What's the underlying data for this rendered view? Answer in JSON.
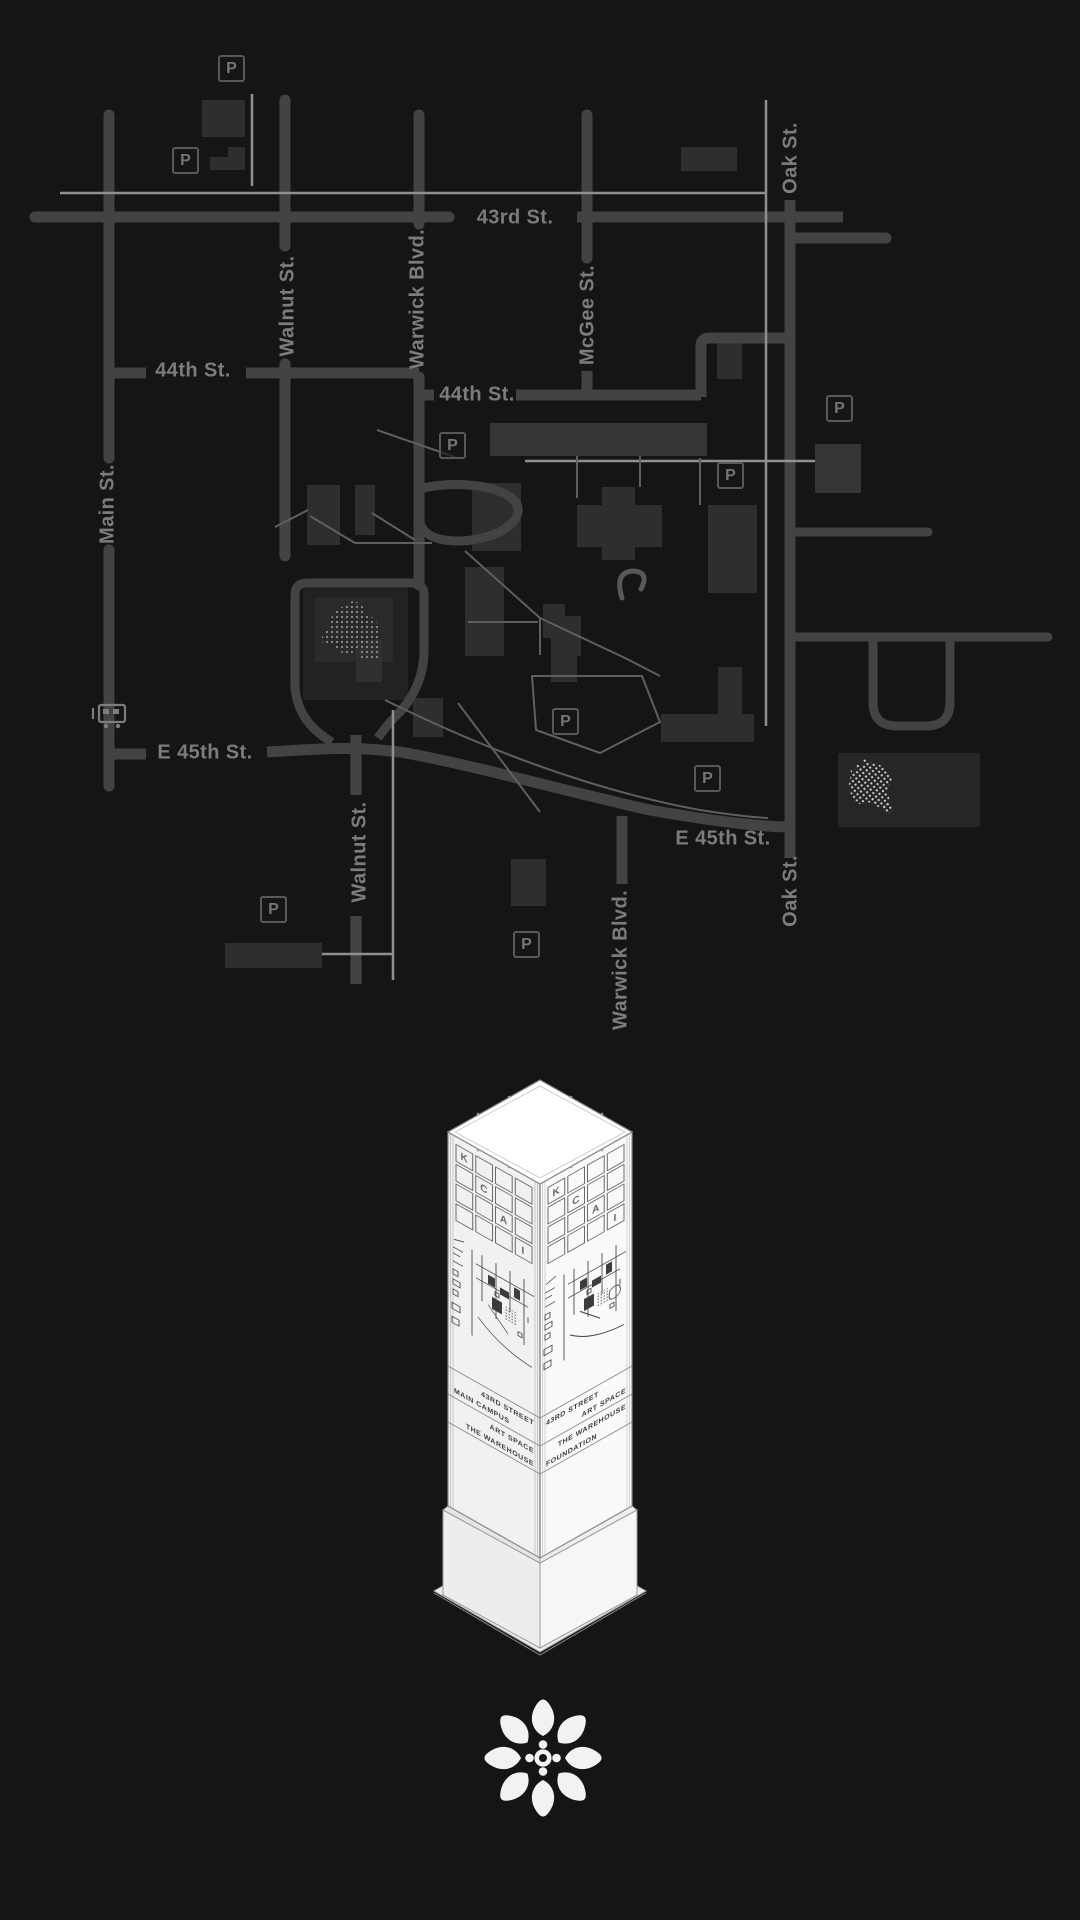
{
  "map": {
    "parking_letter": "P",
    "street_labels": [
      {
        "id": "43rd-st",
        "text": "43rd St."
      },
      {
        "id": "44th-st-left",
        "text": "44th St."
      },
      {
        "id": "44th-st-right",
        "text": "44th St."
      },
      {
        "id": "e-45th-st-west",
        "text": "E 45th St."
      },
      {
        "id": "e-45th-st-east",
        "text": "E 45th St."
      },
      {
        "id": "main-st",
        "text": "Main St."
      },
      {
        "id": "walnut-st-north",
        "text": "Walnut St."
      },
      {
        "id": "walnut-st-south",
        "text": "Walnut St."
      },
      {
        "id": "warwick-blvd-north",
        "text": "Warwick Blvd."
      },
      {
        "id": "warwick-blvd-south",
        "text": "Warwick Blvd."
      },
      {
        "id": "mcgee-st",
        "text": "McGee St."
      },
      {
        "id": "oak-st-north",
        "text": "Oak St."
      },
      {
        "id": "oak-st-south",
        "text": "Oak St."
      }
    ],
    "icons": [
      "parking",
      "streetcar",
      "sculpture",
      "shuttlecock"
    ]
  },
  "pylon": {
    "grid_letters": [
      "K",
      "C",
      "A",
      "I"
    ],
    "faces": {
      "left": {
        "bands": [
          {
            "line1": "43RD STREET",
            "line2": "MAIN CAMPUS"
          },
          {
            "line1": "ART SPACE",
            "line2": "THE WAREHOUSE"
          }
        ]
      },
      "right": {
        "bands": [
          {
            "line1": "43RD STREET",
            "line2": "ART SPACE"
          },
          {
            "line1": "THE WAREHOUSE",
            "line2": "FOUNDATION"
          }
        ]
      }
    }
  },
  "colors": {
    "background": "#151515",
    "road": "#434343",
    "thin_line": "#8f8f8f",
    "building": "#2e2e2e",
    "street_label": "#7c7c7c",
    "pylon_face": "#f2f2f2",
    "logo": "#f2f2f2"
  }
}
